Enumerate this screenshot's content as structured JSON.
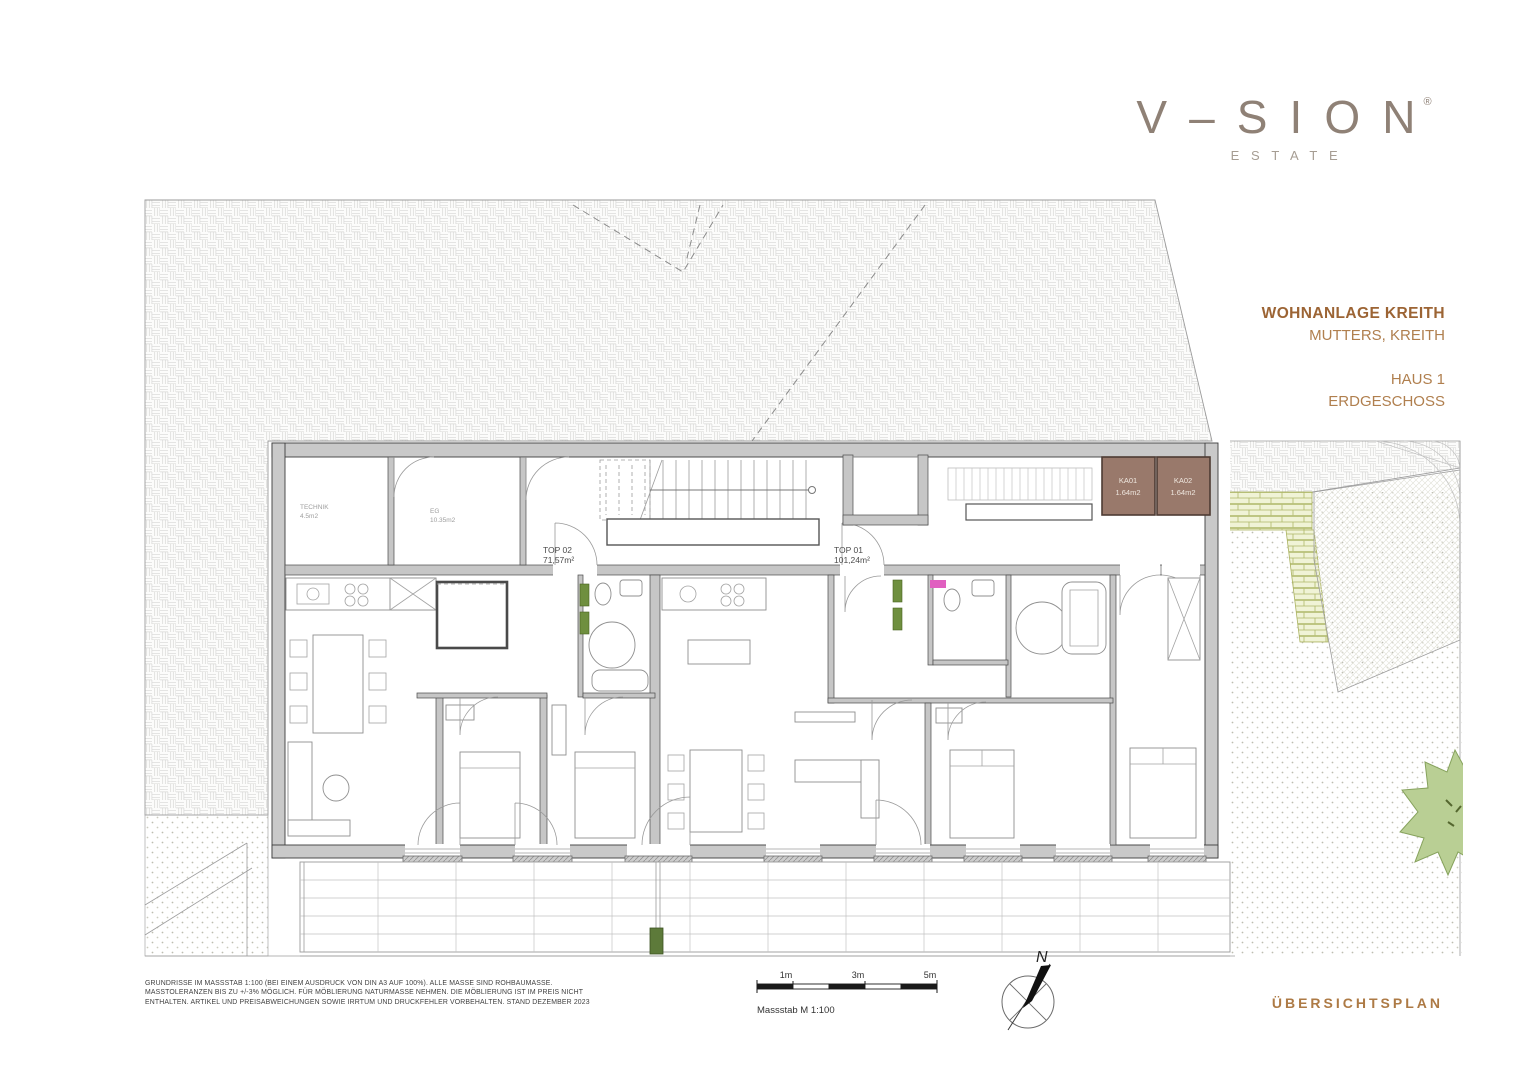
{
  "logo": {
    "wordmark": "V–SION",
    "registered": "®",
    "subtitle": "ESTATE"
  },
  "project": {
    "title": "WOHNANLAGE KREITH",
    "location": "MUTTERS, KREITH",
    "building": "HAUS 1",
    "floor": "ERDGESCHOSS"
  },
  "plan": {
    "units": [
      {
        "id": "TOP 02",
        "area": "71,57m²"
      },
      {
        "id": "TOP 01",
        "area": "101,24m²"
      }
    ],
    "storage_rooms": [
      {
        "id": "KA01",
        "area": "1.64m2"
      },
      {
        "id": "KA02",
        "area": "1.64m2"
      }
    ],
    "service_rooms": [
      {
        "id": "TECHNIK",
        "area": "4.5m2"
      },
      {
        "id": "EG",
        "area": "10.35m2"
      }
    ]
  },
  "footer": {
    "disclaimer": [
      "GRUNDRISSE IM MASSSTAB 1:100 (BEI EINEM AUSDRUCK VON DIN A3 AUF 100%). ALLE MASSE SIND ROHBAUMASSE.",
      "MASSTOLERANZEN BIS ZU +/-3% MÖGLICH. FÜR MÖBLIERUNG NATURMASSE NEHMEN. DIE MÖBLIERUNG IST IM PREIS NICHT",
      "ENTHALTEN. ARTIKEL UND PREISABWEICHUNGEN SOWIE IRRTUM UND DRUCKFEHLER VORBEHALTEN. STAND DEZEMBER 2023"
    ],
    "scale": {
      "ticks": [
        "1m",
        "3m",
        "5m"
      ],
      "label": "Massstab M 1:100"
    },
    "compass_label": "N",
    "plan_type": "ÜBERSICHTSPLAN"
  },
  "colors": {
    "accent": "#a9743f",
    "logo": "#8f8176",
    "wall_fill": "#c9c9c9",
    "storage_fill": "#99796b",
    "storage_border": "#4e3b33",
    "landscape_green": "#b9cf94",
    "hedge_brick": "#f0f3d6"
  }
}
